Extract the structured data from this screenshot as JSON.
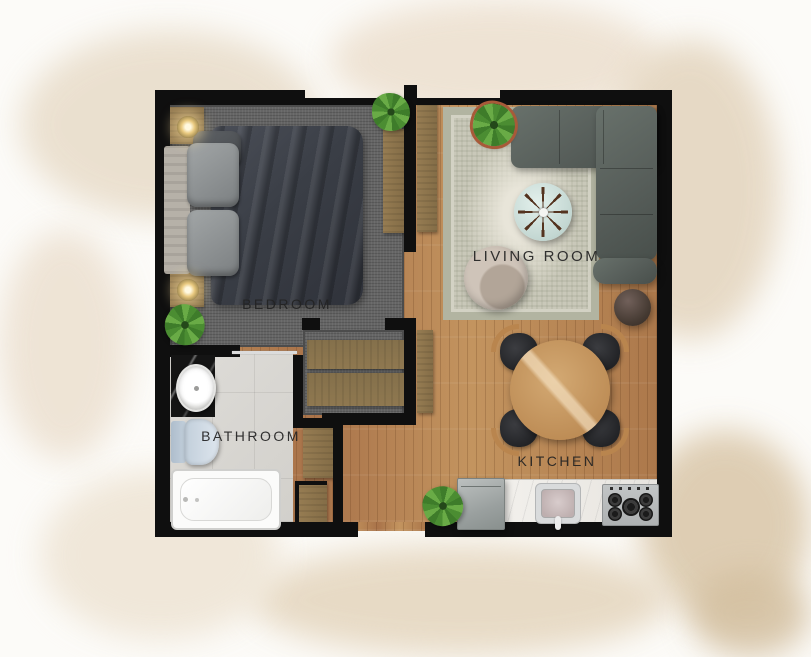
{
  "plan": {
    "rooms": [
      {
        "id": "bedroom",
        "label": "BEDROOM"
      },
      {
        "id": "living_room",
        "label": "LIVING ROOM"
      },
      {
        "id": "bathroom",
        "label": "BATHROOM"
      },
      {
        "id": "kitchen",
        "label": "KITCHEN"
      }
    ],
    "furniture": {
      "bedroom": [
        "double-bed",
        "headboard-bench",
        "nightstand",
        "table-lamp",
        "nightstand",
        "table-lamp",
        "wardrobe",
        "potted-plant",
        "potted-plant"
      ],
      "living_room": [
        "corner-sofa",
        "area-rug",
        "round-coffee-table",
        "armchair",
        "ottoman",
        "potted-plant",
        "tall-cabinet"
      ],
      "bathroom": [
        "vanity-sink",
        "toilet",
        "bathtub"
      ],
      "kitchen": [
        "round-dining-table",
        "dining-chair",
        "dining-chair",
        "dining-chair",
        "dining-chair",
        "refrigerator",
        "kitchen-sink",
        "gas-cooktop",
        "kitchen-counter",
        "potted-plant"
      ],
      "hallway": [
        "closet-shelf",
        "closet-shelf",
        "tall-cabinet",
        "entry-closet"
      ]
    },
    "colors": {
      "walls": "#0f0f0f",
      "wood_floor": "#b5834f",
      "bedroom_carpet": "#616161",
      "bathroom_tile": "#d9d7d3",
      "sofa": "#5a615d",
      "rug": "#cbcabd",
      "dining_table": "#c79c66",
      "counter_marble": "#edebe7",
      "plant_green": "#4e8f33",
      "background_wash": "#e6d8c3"
    }
  }
}
